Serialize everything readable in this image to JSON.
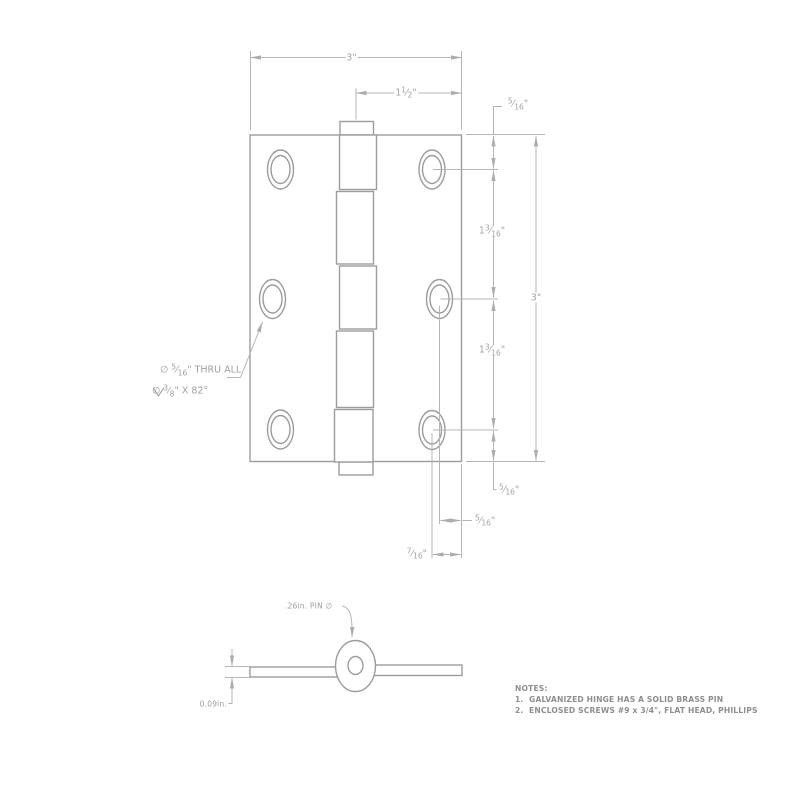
{
  "symbols": {
    "fraction_slash": "⁄",
    "diameter": "∅",
    "degree": "°"
  },
  "front_view": {
    "dim_width": {
      "whole": "3",
      "suffix": "\""
    },
    "dim_center_to_edge": {
      "whole": "1",
      "num": "1",
      "den": "2",
      "suffix": "\""
    },
    "dim_top_edge_to_hole": {
      "num": "5",
      "den": "16",
      "suffix": "\""
    },
    "dim_hole_spacing_upper": {
      "whole": "1",
      "num": "3",
      "den": "16",
      "suffix": "\""
    },
    "dim_height": {
      "whole": "3",
      "suffix": "\""
    },
    "dim_hole_spacing_lower": {
      "whole": "1",
      "num": "3",
      "den": "16",
      "suffix": "\""
    },
    "dim_bottom_edge_to_hole": {
      "num": "5",
      "den": "16",
      "suffix": "\""
    },
    "dim_middle_hole_inset": {
      "num": "5",
      "den": "16",
      "suffix": "\""
    },
    "dim_corner_hole_inset": {
      "num": "7",
      "den": "16",
      "suffix": "\""
    },
    "hole_callout_line1": {
      "prefix": "∅ ",
      "num": "5",
      "den": "16",
      "suffix": "\" THRU ALL"
    },
    "hole_callout_line2": {
      "prefix": "∅ ",
      "num": "3",
      "den": "8",
      "suffix": "\" X 82°"
    }
  },
  "side_view": {
    "pin_diameter_label": ".26in. PIN ∅",
    "thickness_label": "0.09in."
  },
  "notes": {
    "title": "NOTES:",
    "items": [
      "1.  GALVANIZED HINGE HAS A SOLID BRASS PIN",
      "2.  ENCLOSED SCREWS #9 x 3/4\", FLAT HEAD, PHILLIPS"
    ]
  },
  "colors": {
    "model_line": "#9c9c9c",
    "dimension_line": "#b5b5b5",
    "dimension_text": "#a4a4a4",
    "notes_text": "#8e8e8e",
    "background": "#ffffff"
  }
}
